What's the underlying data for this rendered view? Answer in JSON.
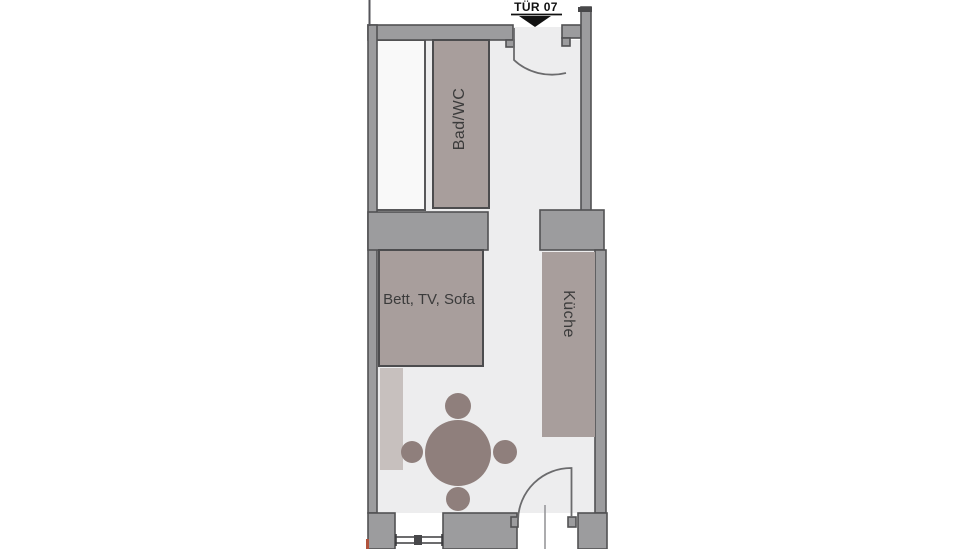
{
  "plan": {
    "entry_door": {
      "label": "TÜR 07"
    },
    "rooms": [
      {
        "name": "bathroom",
        "label": "Bad/WC"
      },
      {
        "name": "living-sleeping",
        "label": "Bett, TV, Sofa"
      },
      {
        "name": "kitchen",
        "label": "Küche"
      }
    ],
    "furniture": [
      {
        "name": "dining-table",
        "shape": "circle"
      },
      {
        "name": "chairs",
        "count": 4
      }
    ],
    "colors": {
      "page_background": "#ffffff",
      "floor": "#ededee",
      "strip_room": "#f9f9f9",
      "wall": "#9c9c9e",
      "wall_dark": "#48484a",
      "wall_outline": "#515153",
      "room_block": "#a89e9c",
      "beige_strip": "#c7c0be",
      "table": "#8f7f7c",
      "door_arc": "#6b6b6d",
      "label_text": "#3b3b3b",
      "door_label_text": "#111111",
      "accent_red": "#b0523c"
    }
  }
}
